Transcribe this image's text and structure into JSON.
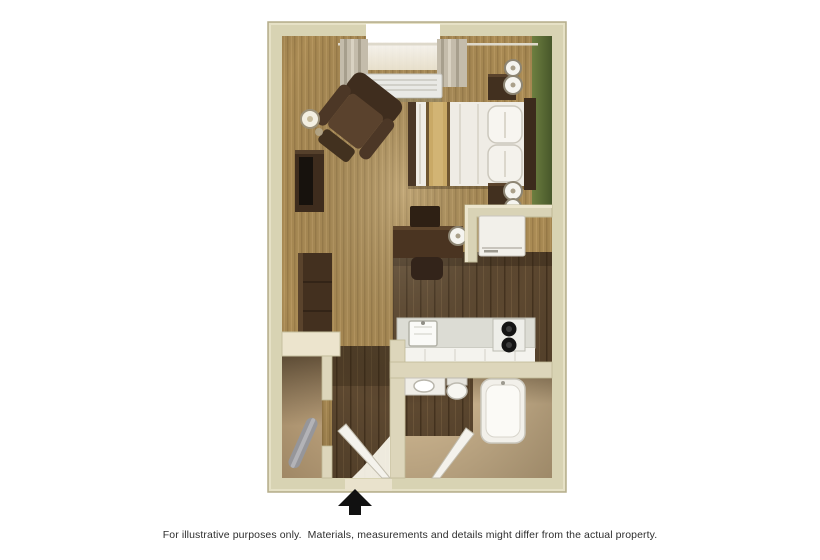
{
  "page": {
    "background": "#ffffff"
  },
  "disclaimer": "For illustrative purposes only.  Materials, measurements and details might differ from the actual property.",
  "floorplan": {
    "type": "3d-rendered studio suite floor plan, top-down view",
    "entry_arrow_direction": "up",
    "colors": {
      "outer_wall": "#d8d3b3",
      "partition_wall": "#ddd6bb",
      "wall_face_light": "#ece4cd",
      "carpet": "#aa8b54",
      "wood_floor": "#5d4830",
      "bath_floor": "#cdb58f",
      "accent_wall_green": "#5c6e33",
      "furniture_wood_dark": "#42301f",
      "linens_white": "#f2efe9",
      "bed_runner_tan": "#c9a966",
      "appliance_white": "#f2f0ea",
      "burner_black": "#141414",
      "arrow_black": "#111111"
    },
    "rooms": [
      "living-sleeping-area",
      "kitchen",
      "bathroom",
      "closet",
      "entry-hall"
    ],
    "furniture": [
      "window-with-curtains",
      "wall-ac-unit",
      "recliner-chair",
      "tv-on-media-stand",
      "floor-lamp",
      "queen-bed-with-runner",
      "pillows",
      "headboard",
      "nightstand-with-lamp-top",
      "nightstand-with-lamp-bottom",
      "dresser",
      "work-desk",
      "desk-chair",
      "desk-lamp",
      "refrigerator",
      "kitchen-counter",
      "kitchen-sink",
      "two-burner-stove",
      "bathroom-vanity",
      "toilet",
      "bathtub",
      "bathroom-door",
      "entry-door",
      "ironing-board"
    ]
  }
}
